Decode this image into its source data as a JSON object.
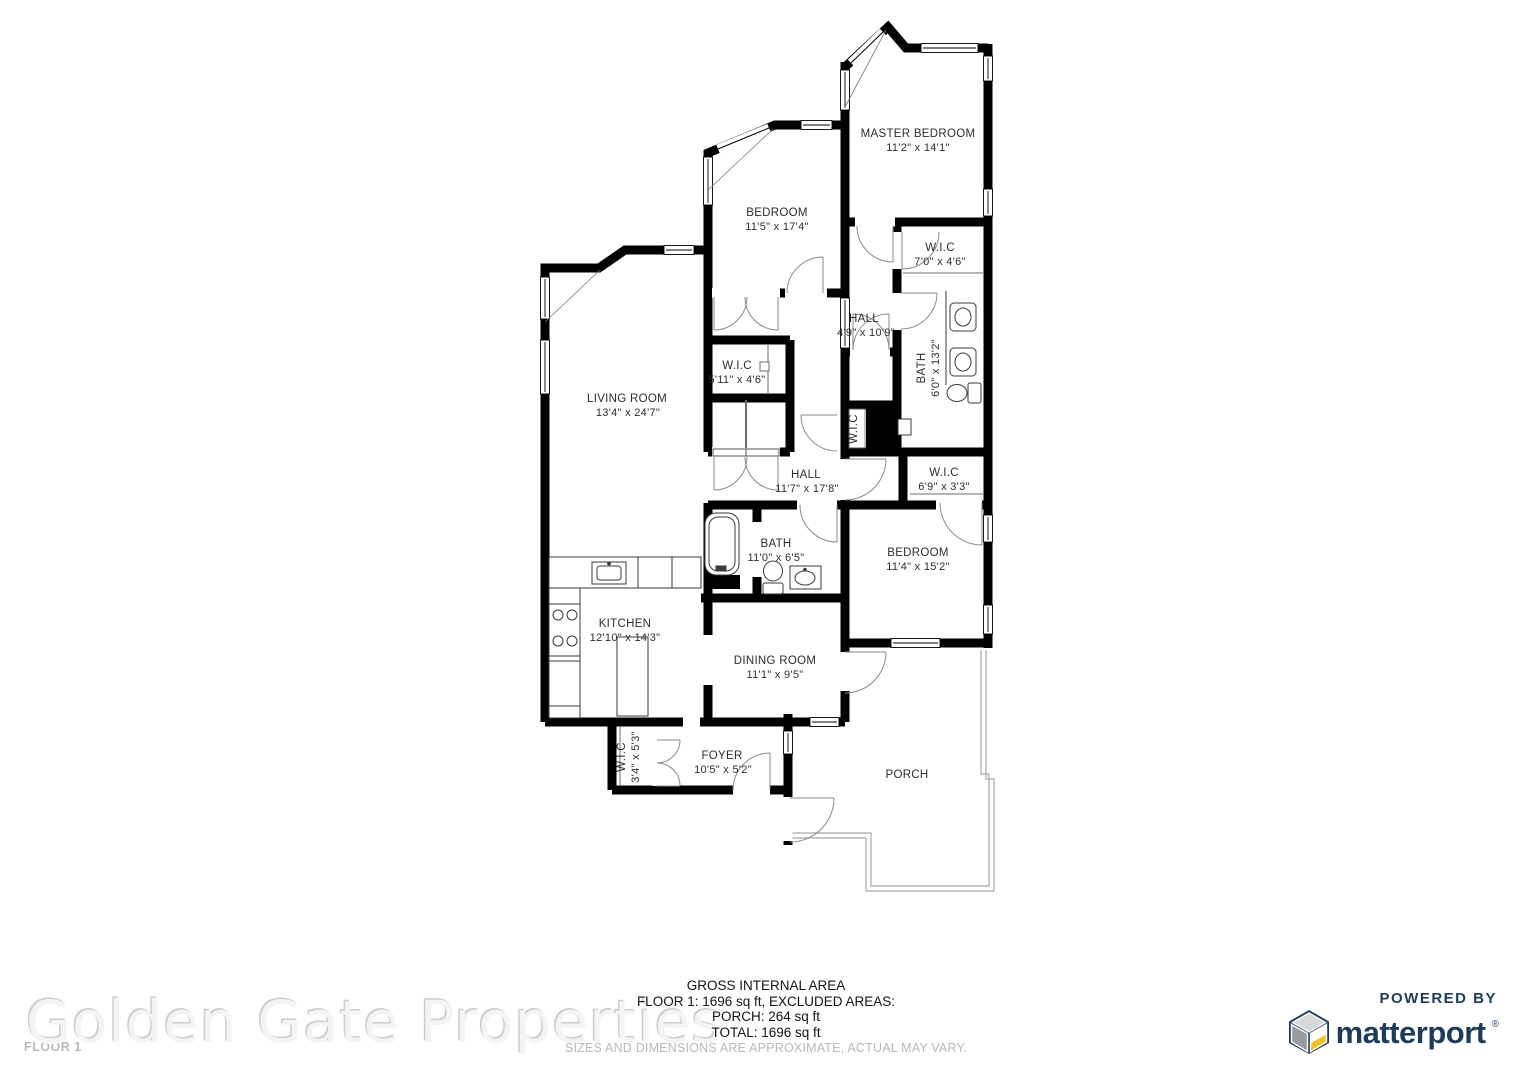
{
  "watermark_text": "Golden Gate Properties",
  "floor_plan": {
    "floor_label": "FLOOR 1",
    "rooms": [
      {
        "id": "master-bedroom",
        "name": "MASTER BEDROOM",
        "dims": "11'2\" x 14'1\""
      },
      {
        "id": "bedroom-1",
        "name": "BEDROOM",
        "dims": "11'5\" x 17'4\""
      },
      {
        "id": "wic-master",
        "name": "W.I.C",
        "dims": "7'0\" x 4'6\""
      },
      {
        "id": "hall-upper",
        "name": "HALL",
        "dims": "4'9\" x 10'9\""
      },
      {
        "id": "bath-master",
        "name": "BATH",
        "dims": "6'0\" x 13'2\""
      },
      {
        "id": "wic-bedroom1",
        "name": "W.I.C",
        "dims": "5'11\" x 4'6\""
      },
      {
        "id": "living-room",
        "name": "LIVING ROOM",
        "dims": "13'4\" x 24'7\""
      },
      {
        "id": "wic-hall",
        "name": "W.I.C",
        "dims": ""
      },
      {
        "id": "hall-main",
        "name": "HALL",
        "dims": "11'7\" x 17'8\""
      },
      {
        "id": "wic-bedroom2",
        "name": "W.I.C",
        "dims": "6'9\" x 3'3\""
      },
      {
        "id": "bath-2",
        "name": "BATH",
        "dims": "11'0\" x 6'5\""
      },
      {
        "id": "bedroom-2",
        "name": "BEDROOM",
        "dims": "11'4\" x 15'2\""
      },
      {
        "id": "kitchen",
        "name": "KITCHEN",
        "dims": "12'10\" x 14'3\""
      },
      {
        "id": "dining-room",
        "name": "DINING ROOM",
        "dims": "11'1\" x 9'5\""
      },
      {
        "id": "wic-foyer",
        "name": "W.I.C",
        "dims": "3'4\" x 5'3\""
      },
      {
        "id": "foyer",
        "name": "FOYER",
        "dims": "10'5\" x 5'2\""
      },
      {
        "id": "porch",
        "name": "PORCH",
        "dims": ""
      }
    ]
  },
  "summary": {
    "title": "GROSS INTERNAL AREA",
    "line2": "FLOOR 1: 1696 sq ft, EXCLUDED AREAS:",
    "line3": "PORCH: 264 sq ft",
    "line4": "TOTAL: 1696 sq ft",
    "disclaimer": "SIZES AND DIMENSIONS ARE APPROXIMATE, ACTUAL MAY VARY."
  },
  "branding": {
    "powered_by": "POWERED BY",
    "brand_name": "matterport",
    "registered_mark": "®",
    "navy": "#1d3c5c",
    "yellow": "#f2c220",
    "cube_gray_light": "#d6d8da",
    "cube_gray_dark": "#989ca1",
    "cube_icon": "matterport-cube-icon"
  }
}
